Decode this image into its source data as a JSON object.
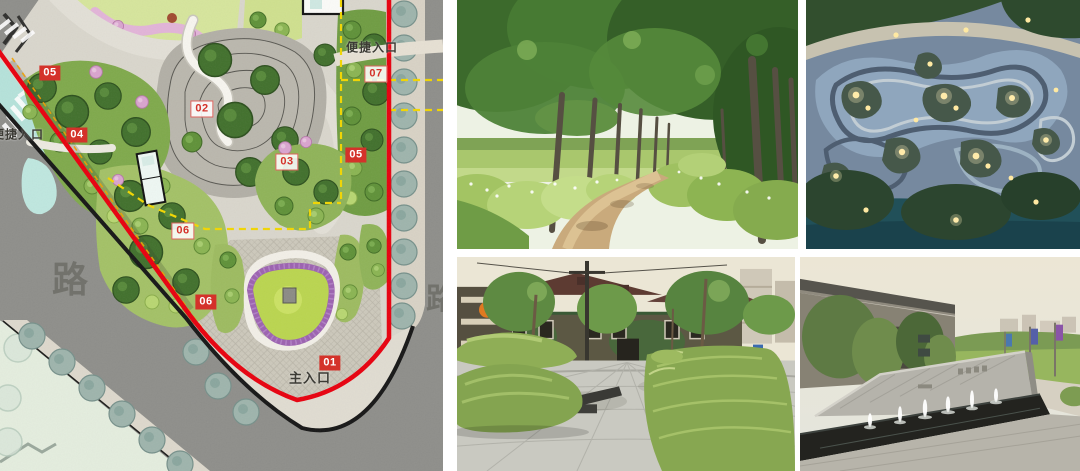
{
  "slide": {
    "background": "#ffffff"
  },
  "site_plan": {
    "title": "landscape-master-plan",
    "zone_labels": [
      {
        "text": "05",
        "variant": "solid",
        "x": 50,
        "y": 73
      },
      {
        "text": "07",
        "variant": "outline",
        "x": 376,
        "y": 74
      },
      {
        "text": "02",
        "variant": "outline",
        "x": 202,
        "y": 109
      },
      {
        "text": "04",
        "variant": "solid",
        "x": 77,
        "y": 135
      },
      {
        "text": "05",
        "variant": "solid",
        "x": 356,
        "y": 155
      },
      {
        "text": "03",
        "variant": "outline",
        "x": 287,
        "y": 162
      },
      {
        "text": "06",
        "variant": "outline",
        "x": 183,
        "y": 231
      },
      {
        "text": "06",
        "variant": "solid",
        "x": 206,
        "y": 302
      },
      {
        "text": "01",
        "variant": "solid",
        "x": 330,
        "y": 363
      }
    ],
    "entrance_labels": [
      {
        "text": "便捷入口",
        "x": 18,
        "y": 134,
        "size": 12
      },
      {
        "text": "便捷入口",
        "x": 372,
        "y": 47,
        "size": 12
      },
      {
        "text": "主入口",
        "x": 310,
        "y": 377,
        "size": 13
      }
    ],
    "street_labels": [
      {
        "text": "路",
        "x": 70,
        "y": 277,
        "size": 36
      },
      {
        "text": "路",
        "x": 441,
        "y": 296,
        "size": 30
      }
    ],
    "legend_colors": {
      "site_boundary_red": "#e8000e",
      "road_edge_black": "#161616",
      "analysis_dash_yellow": "#f2d600",
      "water_band_teal": "#b5e2da"
    }
  },
  "reference_photos": [
    {
      "id": "tree-lined-lane",
      "label": "Tree-lined country lane with hedgerows"
    },
    {
      "id": "aerial-night-park",
      "label": "Aerial night view of curvilinear terraced waterfront park"
    },
    {
      "id": "hedge-mound-plaza",
      "label": "Urban plaza with sculpted hedge mounds"
    },
    {
      "id": "entry-water-feature",
      "label": "Angled stone entry wall with fountain pool"
    }
  ]
}
